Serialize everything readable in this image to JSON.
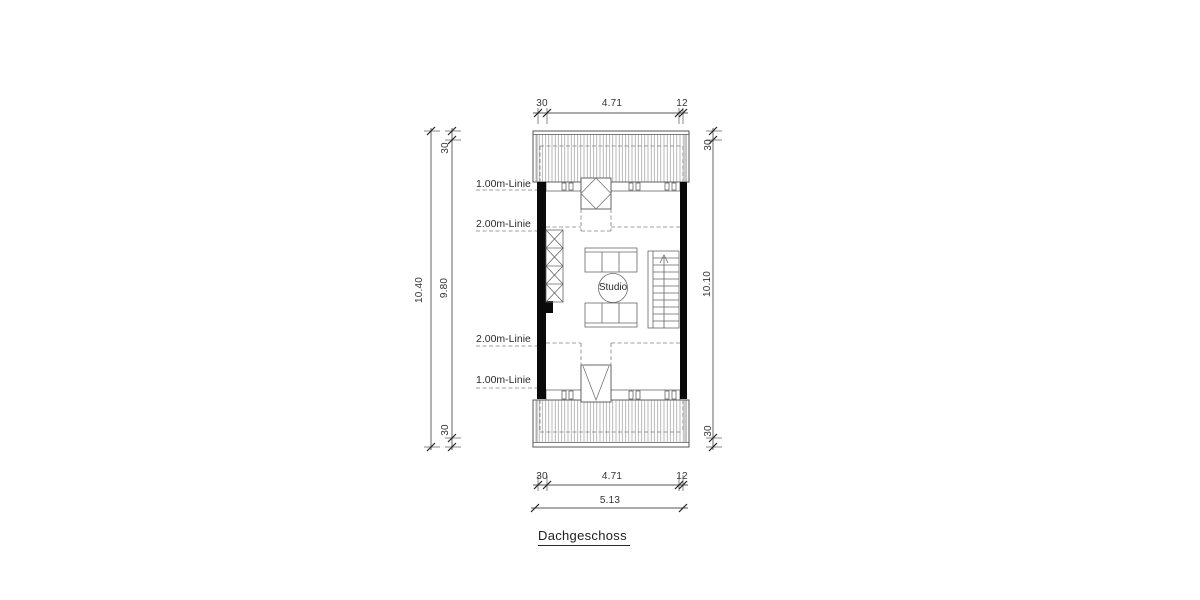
{
  "title": "Dachgeschoss",
  "room_label": "Studio",
  "height_lines": {
    "one": "1.00m-Linie",
    "two": "2.00m-Linie"
  },
  "dimensions": {
    "top": {
      "wall_left": "30",
      "interior": "4.71",
      "wall_right": "12"
    },
    "bottom": {
      "wall_left": "30",
      "interior": "4.71",
      "wall_right": "12",
      "total": "5.13"
    },
    "left": {
      "total": "10.40",
      "top_offset": "30",
      "interior": "9.80",
      "bottom_offset": "30"
    },
    "right": {
      "top_offset": "30",
      "interior": "10.10",
      "bottom_offset": "30"
    }
  },
  "colors": {
    "background": "#ffffff",
    "wall_fill": "#0a0a0a",
    "line": "#555555",
    "hatch": "#999999",
    "dashed": "#808080",
    "text": "#333333"
  }
}
